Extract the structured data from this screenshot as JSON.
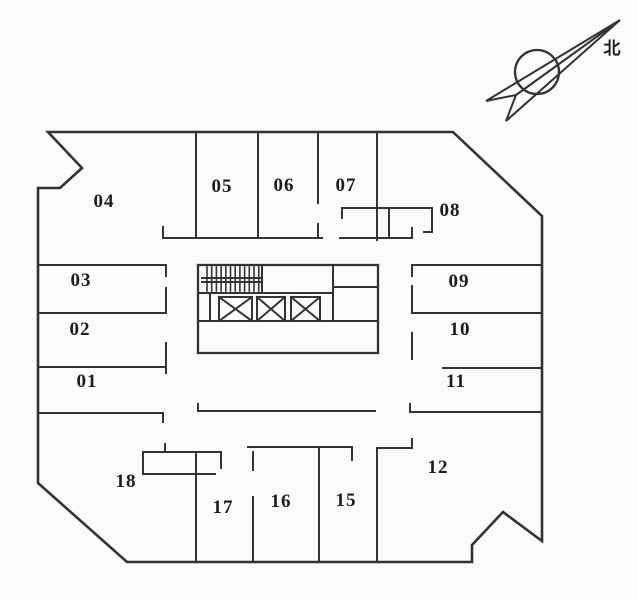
{
  "compass": {
    "label": "北"
  },
  "rooms": [
    {
      "id": "01",
      "x": 87,
      "y": 387
    },
    {
      "id": "02",
      "x": 80,
      "y": 335
    },
    {
      "id": "03",
      "x": 81,
      "y": 286
    },
    {
      "id": "04",
      "x": 104,
      "y": 207
    },
    {
      "id": "05",
      "x": 222,
      "y": 192
    },
    {
      "id": "06",
      "x": 284,
      "y": 191
    },
    {
      "id": "07",
      "x": 346,
      "y": 191
    },
    {
      "id": "08",
      "x": 450,
      "y": 216
    },
    {
      "id": "09",
      "x": 459,
      "y": 287
    },
    {
      "id": "10",
      "x": 460,
      "y": 335
    },
    {
      "id": "11",
      "x": 456,
      "y": 387
    },
    {
      "id": "12",
      "x": 438,
      "y": 473
    },
    {
      "id": "15",
      "x": 346,
      "y": 506
    },
    {
      "id": "16",
      "x": 281,
      "y": 507
    },
    {
      "id": "17",
      "x": 223,
      "y": 513
    },
    {
      "id": "18",
      "x": 126,
      "y": 487
    }
  ],
  "colors": {
    "line": "#333333",
    "background": "#fbfbfb",
    "label": "#1c1c1c"
  }
}
